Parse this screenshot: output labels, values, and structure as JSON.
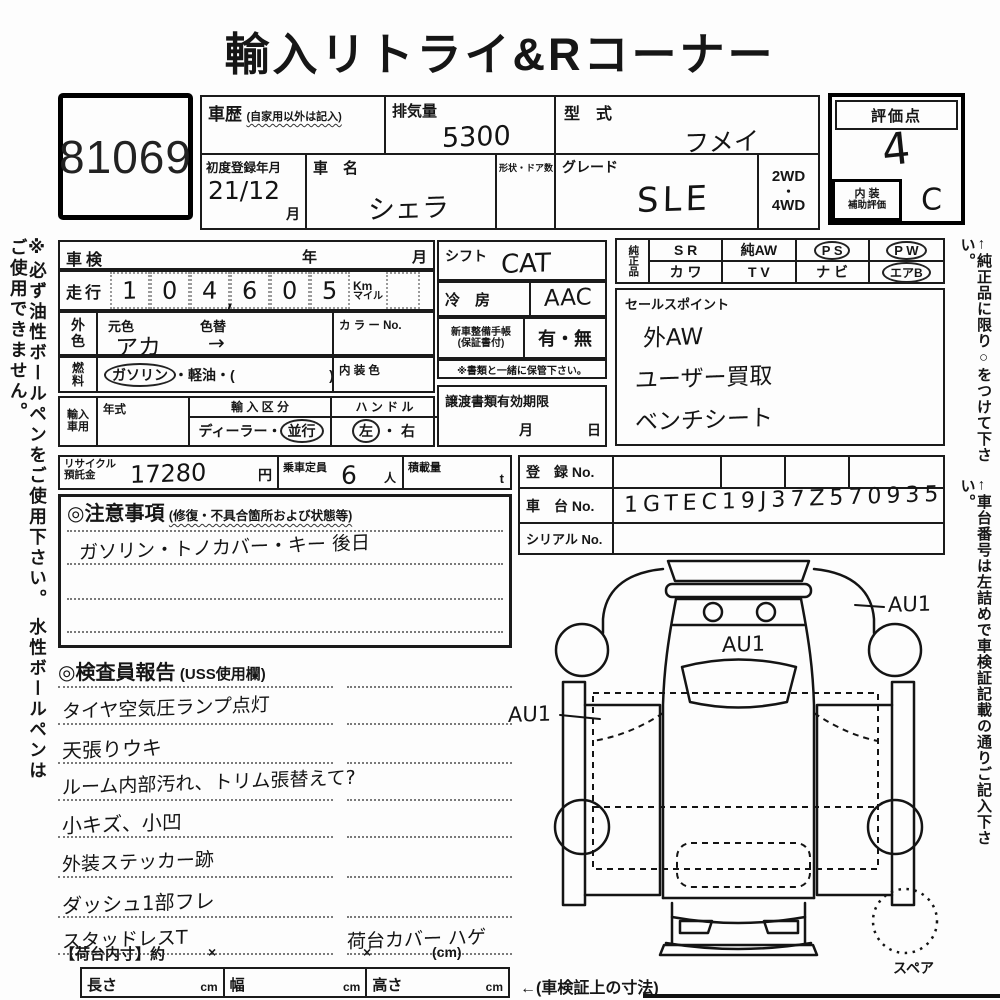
{
  "title": "輸入リトライ&Rコーナー",
  "lot_no": "81069",
  "header": {
    "history_label": "車歴",
    "history_note": "(自家用以外は記入)",
    "displacement_label": "排気量",
    "displacement_value": "5300",
    "model_label": "型　式",
    "model_value": "フメイ",
    "first_reg_label": "初度登録年月",
    "first_reg_value": "21/12",
    "first_reg_unit": "月",
    "car_name_label": "車　名",
    "car_name_value": "シェラ",
    "shape_doors_label": "形状・ドア数",
    "grade_label": "グレード",
    "grade_value": "SLE",
    "drive_2wd": "2WD",
    "drive_dot": "・",
    "drive_4wd": "4WD",
    "score_label": "評価点",
    "score_value": "4",
    "interior_label_1": "内 装",
    "interior_label_2": "補助評価",
    "interior_value": "C"
  },
  "notes": {
    "left_vertical": "※必ず油性ボールペンをご使用下さい。 水性ボールペンはご使用できません。",
    "right_vertical_1": "←純正品に限り○をつけて下さい。",
    "right_vertical_2": "←車台番号は左詰めで車検証記載の通りご記入下さい。"
  },
  "left": {
    "shaken_label": "車検",
    "shaken_year": "年",
    "shaken_month": "月",
    "mileage_label": "走行",
    "mileage_digits": [
      "1",
      "0",
      "4",
      "6",
      "0",
      "5"
    ],
    "mileage_comma": ",",
    "unit_km": "Km",
    "unit_mile": "マイル",
    "color_label_1": "外",
    "color_label_2": "色",
    "orig_color_label": "元色",
    "color_change_label": "色替",
    "orig_color_value": "アカ",
    "color_arrow": "→",
    "color_no_label": "カ ラ ー No.",
    "fuel_label_1": "燃",
    "fuel_label_2": "料",
    "fuel_circled": "ガソリン",
    "fuel_rest": "・軽油・(",
    "fuel_close": ")",
    "interior_color_label": "内 装 色",
    "import_label_1": "輸入",
    "import_label_2": "車用",
    "year_type_label": "年式",
    "import_class_label": "輸 入 区 分",
    "import_class_pre": "ディーラー・",
    "import_class_circled": "並行",
    "handle_label": "ハ ン ド ル",
    "handle_left": "左",
    "handle_dot": "・",
    "handle_right": "右"
  },
  "recycle": {
    "label_1": "リサイクル",
    "label_2": "預託金",
    "value": "17280",
    "unit": "円",
    "capacity_label": "乗車定員",
    "capacity_value": "6",
    "capacity_unit": "人",
    "load_label": "積載量",
    "load_unit": "t"
  },
  "cautions": {
    "heading": "◎注意事項",
    "note": "(修復・不具合箇所および状態等)",
    "line_1": "ガソリン・トノカバー・キー 後日"
  },
  "middle": {
    "shift_label": "シフト",
    "shift_value": "CAT",
    "ac_label": "冷　房",
    "ac_value": "AAC",
    "book_label_1": "新車整備手帳",
    "book_label_2": "(保証書付)",
    "book_value": "有・無",
    "book_note": "※書類と一緒に保管下さい。",
    "transfer_label": "譲渡書類有効期限",
    "transfer_month": "月",
    "transfer_day": "日"
  },
  "genuine": {
    "label": "純正品",
    "col1_top": "S R",
    "col1_bottom": "カ ワ",
    "col2_top": "純AW",
    "col2_bottom": "T V",
    "col3_top": "P S",
    "col3_bottom": "ナ ビ",
    "col4_top": "P W",
    "col4_bottom": "エアB"
  },
  "sales": {
    "label": "セールスポイント",
    "line_1": "外AW",
    "line_2": "ユーザー買取",
    "line_3": "ベンチシート"
  },
  "registration": {
    "reg_label": "登　録 No.",
    "chassis_label": "車　台 No.",
    "chassis_value": "1GTEC19J37Z570935",
    "serial_label": "シリアル No."
  },
  "inspector": {
    "heading": "◎検査員報告",
    "note": "(USS使用欄)",
    "rows": [
      {
        "left": "タイヤ空気圧ランプ点灯",
        "right": ""
      },
      {
        "left": "天張りウキ",
        "right": ""
      },
      {
        "left": "ルーム内部汚れ、トリム張替えて?",
        "right": ""
      },
      {
        "left": "小キズ、小凹",
        "right": ""
      },
      {
        "left": "外装ステッカー跡",
        "right": ""
      },
      {
        "left": "ダッシュ1部フレ",
        "right": ""
      },
      {
        "left": "スタッドレスT",
        "right": "荷台カバー ハゲ"
      }
    ]
  },
  "bed": {
    "label": "【荷台内寸】約",
    "x1": "×",
    "x2": "×",
    "unit": "(cm)"
  },
  "dims": {
    "length_label": "長さ",
    "width_label": "幅",
    "height_label": "高さ",
    "unit": "cm",
    "note": "←(車検証上の寸法)"
  },
  "diagram": {
    "au1_left": "AU1",
    "au1_center": "AU1",
    "au1_right": "AU1",
    "spare": "スペア"
  }
}
